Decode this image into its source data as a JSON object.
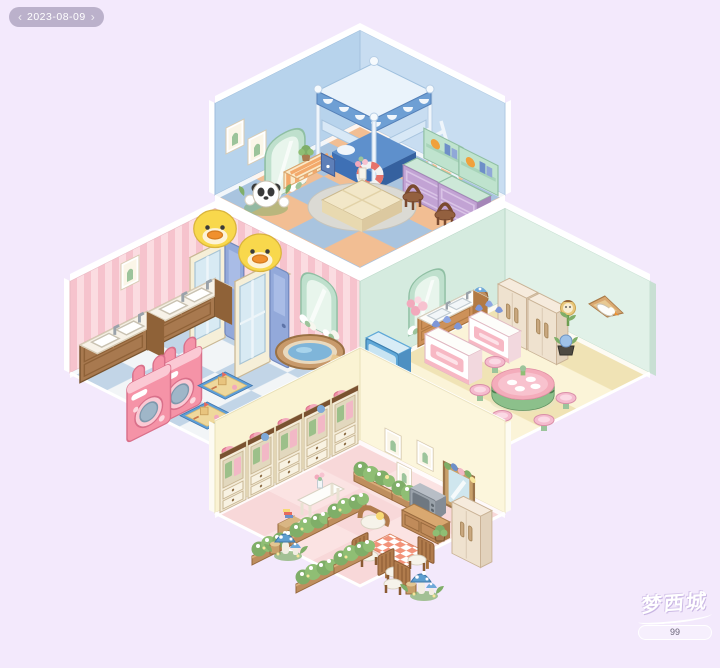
{
  "hud": {
    "date_badge": {
      "prev_icon": "‹",
      "label": "2023-08-09",
      "next_icon": "›"
    }
  },
  "watermark": {
    "logo_text": "梦西城",
    "id_label": "99"
  },
  "colors": {
    "bg": "#F3E9FC",
    "hud_pill": "rgba(150,140,170,0.6)",
    "hud_text": "#FFFFFF",
    "trim": "#FFFFFF",
    "band_cream": "#F5EEC9",
    "bed_wall_left": "#B7D3EC",
    "bed_wall_right": "#C8DDF1",
    "bed_floor_a": "#F2BE93",
    "bed_floor_b": "#A9C4DF",
    "bath_wall_a": "#FBDCE1",
    "bath_wall_b": "#F6C3CD",
    "bath_floor_a": "#F2F5F7",
    "bath_floor_b": "#C2D5E7",
    "kit_wall_left": "#D5EBDF",
    "kit_wall_right": "#E1F1E8",
    "kit_floor_a": "#FBF4D8",
    "kit_floor_b": "#F0E3B5",
    "liv_wall_left": "#FAF3D3",
    "liv_wall_right": "#FCF6DC",
    "liv_floor_a": "#F8D8D9",
    "liv_floor_b": "#FBE3E3"
  },
  "scene": {
    "layout": "four isometric rooms in a diamond",
    "rooms": [
      {
        "id": "bedroom-top",
        "style": "blue",
        "items": [
          "framed-picture",
          "framed-picture",
          "arched-mirror-with-flowers",
          "canopy-bunk-bed",
          "bed-ladder",
          "swim-ring",
          "striped-storage-bench",
          "potted-plant",
          "panda-flower-ornament",
          "study-desk-with-hutch",
          "study-desk-with-hutch",
          "wooden-chair",
          "wooden-chair",
          "round-rug",
          "wooden-tea-table",
          "flower-vase"
        ]
      },
      {
        "id": "bathroom-left",
        "style": "pink-stripe",
        "items": [
          "framed-picture",
          "double-sink-vanity",
          "double-sink-vanity",
          "bunny-washing-machine",
          "bunny-washing-machine",
          "duck-shower-stall",
          "duck-shower-stall",
          "arched-mirror-with-flowers",
          "wooden-bathtub",
          "sandbox-play-pit",
          "sandbox-play-pit"
        ]
      },
      {
        "id": "kitchen-right",
        "style": "mint",
        "items": [
          "arched-mirror-with-flowers",
          "kitchen-sink-counter",
          "flower-bouquet",
          "display-cooler",
          "dessert-counter",
          "dessert-counter",
          "double-door-refrigerator",
          "double-door-refrigerator",
          "teddy-planter",
          "goose-glider-wall-decor",
          "sunflower-character",
          "potted-sprout",
          "watermelon-dining-table",
          "flower-stool",
          "flower-stool",
          "flower-stool",
          "flower-stool",
          "flower-stool"
        ]
      },
      {
        "id": "living-room-bottom",
        "style": "cream",
        "items": [
          "wardrobe-with-hat",
          "wardrobe-with-hat",
          "wardrobe-with-hat",
          "wardrobe-with-hat",
          "wardrobe-with-hat",
          "cactus-picture",
          "cactus-picture",
          "cactus-picture",
          "wall-mirror-with-garland",
          "console-table-with-vase",
          "book-stool",
          "flower-hedge",
          "flower-hedge",
          "flower-hedge",
          "crt-television",
          "tv-stand",
          "potted-plant",
          "double-door-refrigerator",
          "armchair",
          "gingham-dining-table",
          "cushioned-chair",
          "cushioned-chair",
          "cushioned-chair",
          "cushioned-chair",
          "blue-mushroom-cluster",
          "blue-mushroom-cluster"
        ]
      }
    ]
  }
}
